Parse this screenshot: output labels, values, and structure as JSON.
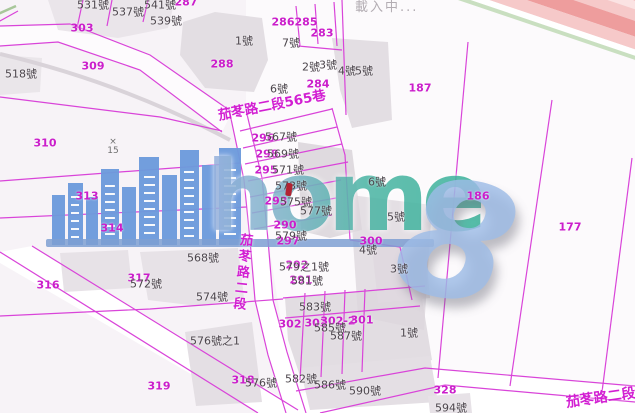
{
  "map": {
    "loading_text": "載入中...",
    "street_labels": {
      "lane_565": "茄苳路二段565巷",
      "road_vertical": "茄苳路二段",
      "road_bottom": "茄苳路二段"
    },
    "survey_marker": {
      "symbol": "×",
      "value": "15"
    },
    "colors": {
      "parcel_line": "#d944d9",
      "parcel_label": "#cb1ecb",
      "address_label": "#4b444b",
      "road_fill": "#ffffff",
      "block_fill": "#e3dee3",
      "background": "#f7f3f7",
      "highway_stripe": "#ee9d9d",
      "highway_edge_green": "#c9dfc0"
    },
    "parcel_labels": [
      {
        "text": "287",
        "x": 186,
        "y": 2
      },
      {
        "text": "303",
        "x": 82,
        "y": 28
      },
      {
        "text": "309",
        "x": 93,
        "y": 66
      },
      {
        "text": "288",
        "x": 222,
        "y": 64
      },
      {
        "text": "286",
        "x": 283,
        "y": 22
      },
      {
        "text": "285",
        "x": 306,
        "y": 22
      },
      {
        "text": "283",
        "x": 322,
        "y": 33
      },
      {
        "text": "284",
        "x": 318,
        "y": 84
      },
      {
        "text": "187",
        "x": 420,
        "y": 88
      },
      {
        "text": "310",
        "x": 45,
        "y": 143
      },
      {
        "text": "313",
        "x": 87,
        "y": 196
      },
      {
        "text": "314",
        "x": 112,
        "y": 228
      },
      {
        "text": "186",
        "x": 478,
        "y": 196
      },
      {
        "text": "177",
        "x": 570,
        "y": 227
      },
      {
        "text": "296",
        "x": 263,
        "y": 138
      },
      {
        "text": "298",
        "x": 267,
        "y": 154
      },
      {
        "text": "295",
        "x": 266,
        "y": 170
      },
      {
        "text": "293",
        "x": 276,
        "y": 201
      },
      {
        "text": "290",
        "x": 285,
        "y": 225
      },
      {
        "text": "297",
        "x": 288,
        "y": 241
      },
      {
        "text": "300",
        "x": 371,
        "y": 241
      },
      {
        "text": "292",
        "x": 297,
        "y": 265
      },
      {
        "text": "291",
        "x": 301,
        "y": 280
      },
      {
        "text": "302",
        "x": 290,
        "y": 324
      },
      {
        "text": "303",
        "x": 316,
        "y": 323
      },
      {
        "text": "302-2",
        "x": 338,
        "y": 321
      },
      {
        "text": "301",
        "x": 362,
        "y": 320
      },
      {
        "text": "316",
        "x": 48,
        "y": 285
      },
      {
        "text": "317",
        "x": 139,
        "y": 278
      },
      {
        "text": "319",
        "x": 159,
        "y": 386
      },
      {
        "text": "318",
        "x": 243,
        "y": 380
      },
      {
        "text": "328",
        "x": 445,
        "y": 390
      }
    ],
    "address_labels": [
      {
        "text": "531號",
        "x": 93,
        "y": 5
      },
      {
        "text": "537號",
        "x": 128,
        "y": 12
      },
      {
        "text": "541號",
        "x": 160,
        "y": 5
      },
      {
        "text": "539號",
        "x": 166,
        "y": 21
      },
      {
        "text": "518號",
        "x": 21,
        "y": 74
      },
      {
        "text": "1號",
        "x": 244,
        "y": 41
      },
      {
        "text": "7號",
        "x": 291,
        "y": 43
      },
      {
        "text": "2號",
        "x": 311,
        "y": 67
      },
      {
        "text": "3號",
        "x": 328,
        "y": 65
      },
      {
        "text": "4號",
        "x": 347,
        "y": 71
      },
      {
        "text": "5號",
        "x": 364,
        "y": 71
      },
      {
        "text": "6號",
        "x": 279,
        "y": 89
      },
      {
        "text": "567號",
        "x": 281,
        "y": 137
      },
      {
        "text": "569號",
        "x": 283,
        "y": 154
      },
      {
        "text": "571號",
        "x": 288,
        "y": 170
      },
      {
        "text": "573號",
        "x": 291,
        "y": 186
      },
      {
        "text": "575號",
        "x": 296,
        "y": 202
      },
      {
        "text": "577號",
        "x": 316,
        "y": 211
      },
      {
        "text": "6號",
        "x": 377,
        "y": 182
      },
      {
        "text": "5號",
        "x": 396,
        "y": 217
      },
      {
        "text": "579號",
        "x": 291,
        "y": 236
      },
      {
        "text": "4號",
        "x": 368,
        "y": 250
      },
      {
        "text": "3號",
        "x": 399,
        "y": 269
      },
      {
        "text": "568號",
        "x": 203,
        "y": 258
      },
      {
        "text": "579之1號",
        "x": 304,
        "y": 267
      },
      {
        "text": "581號",
        "x": 307,
        "y": 281
      },
      {
        "text": "572號",
        "x": 146,
        "y": 284
      },
      {
        "text": "574號",
        "x": 212,
        "y": 297
      },
      {
        "text": "583號",
        "x": 315,
        "y": 307
      },
      {
        "text": "585號",
        "x": 330,
        "y": 328
      },
      {
        "text": "587號",
        "x": 346,
        "y": 336
      },
      {
        "text": "1號",
        "x": 409,
        "y": 333
      },
      {
        "text": "576號之1",
        "x": 215,
        "y": 341
      },
      {
        "text": "576號",
        "x": 261,
        "y": 383
      },
      {
        "text": "582號",
        "x": 301,
        "y": 379
      },
      {
        "text": "586號",
        "x": 330,
        "y": 385
      },
      {
        "text": "590號",
        "x": 365,
        "y": 391
      },
      {
        "text": "594號",
        "x": 451,
        "y": 408
      }
    ]
  },
  "watermark": {
    "brand_text": "home",
    "brand_number": "8",
    "bar_color": "#7e9fd2",
    "skyline_color": "#6d9bdc",
    "text_gradient": [
      "#9db4e0",
      "#79b4c4",
      "#3eb49c"
    ]
  }
}
